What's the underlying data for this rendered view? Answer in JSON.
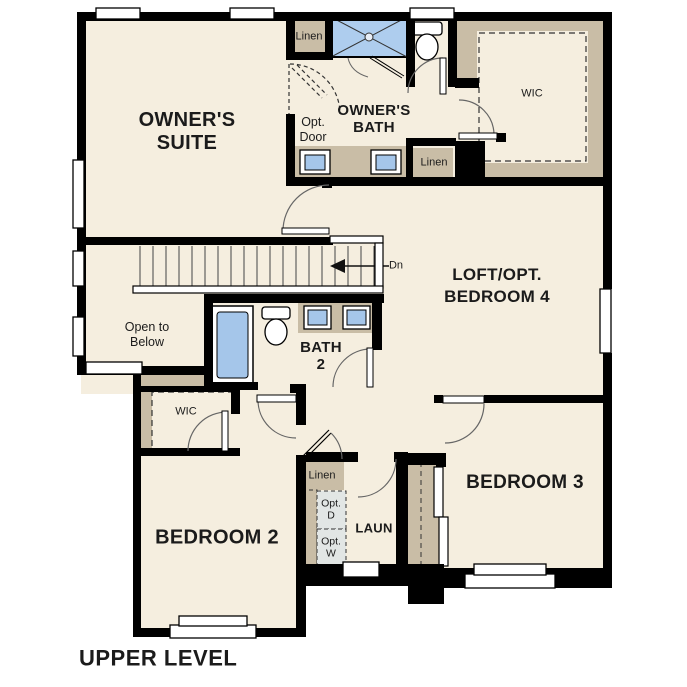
{
  "plan": {
    "level_title": "UPPER LEVEL",
    "rooms": {
      "owners_suite": "OWNER'S\nSUITE",
      "owners_bath": "OWNER'S\nBATH",
      "wic_owners": "WIC",
      "loft": "LOFT/OPT.\nBEDROOM 4",
      "bath2": "BATH\n2",
      "bedroom2": "BEDROOM 2",
      "bedroom3": "BEDROOM 3",
      "laundry": "LAUN",
      "wic_bedroom2": "WIC"
    },
    "annotations": {
      "linen_upper": "Linen",
      "linen_bath": "Linen",
      "linen_hall": "Linen",
      "opt_door": "Opt.\nDoor",
      "open_to_below": "Open to\nBelow",
      "stairs_direction": "Dn",
      "opt_dryer": "Opt.\nD",
      "opt_washer": "Opt.\nW"
    },
    "colors": {
      "wall": "#000000",
      "floor": "#f5eedf",
      "closet_tan": "#c9bda6",
      "fixture_blue": "#a5c6ea",
      "shower_blue": "#aecdee",
      "appliance_gray": "#e2e6e5",
      "door_arc": "#666666",
      "text": "#1b1b1b"
    }
  }
}
